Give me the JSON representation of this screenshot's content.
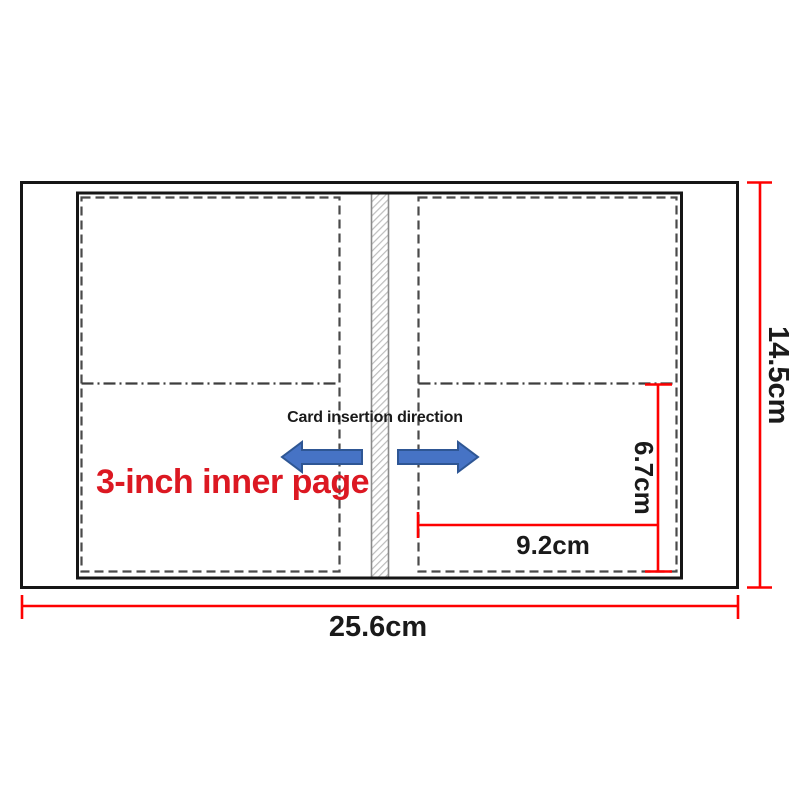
{
  "diagram": {
    "insertion_label": "Card insertion direction",
    "page_type_label": "3-inch inner page",
    "dimensions": {
      "overall_width": "25.6cm",
      "overall_height": "14.5cm",
      "pocket_width": "9.2cm",
      "pocket_depth": "6.7cm"
    },
    "icons": {
      "left_arrow": "left-direction-arrow",
      "right_arrow": "right-direction-arrow"
    },
    "colors": {
      "dimension_line_red": "#fe0000",
      "page_label_red": "#dc1822",
      "arrow_blue_fill": "#4673c5",
      "arrow_blue_border": "#2e5694",
      "outline_black": "#161616",
      "pocket_dash_gray": "#4a4a4a",
      "spine_hatch_gray": "#bdbdbd"
    }
  }
}
